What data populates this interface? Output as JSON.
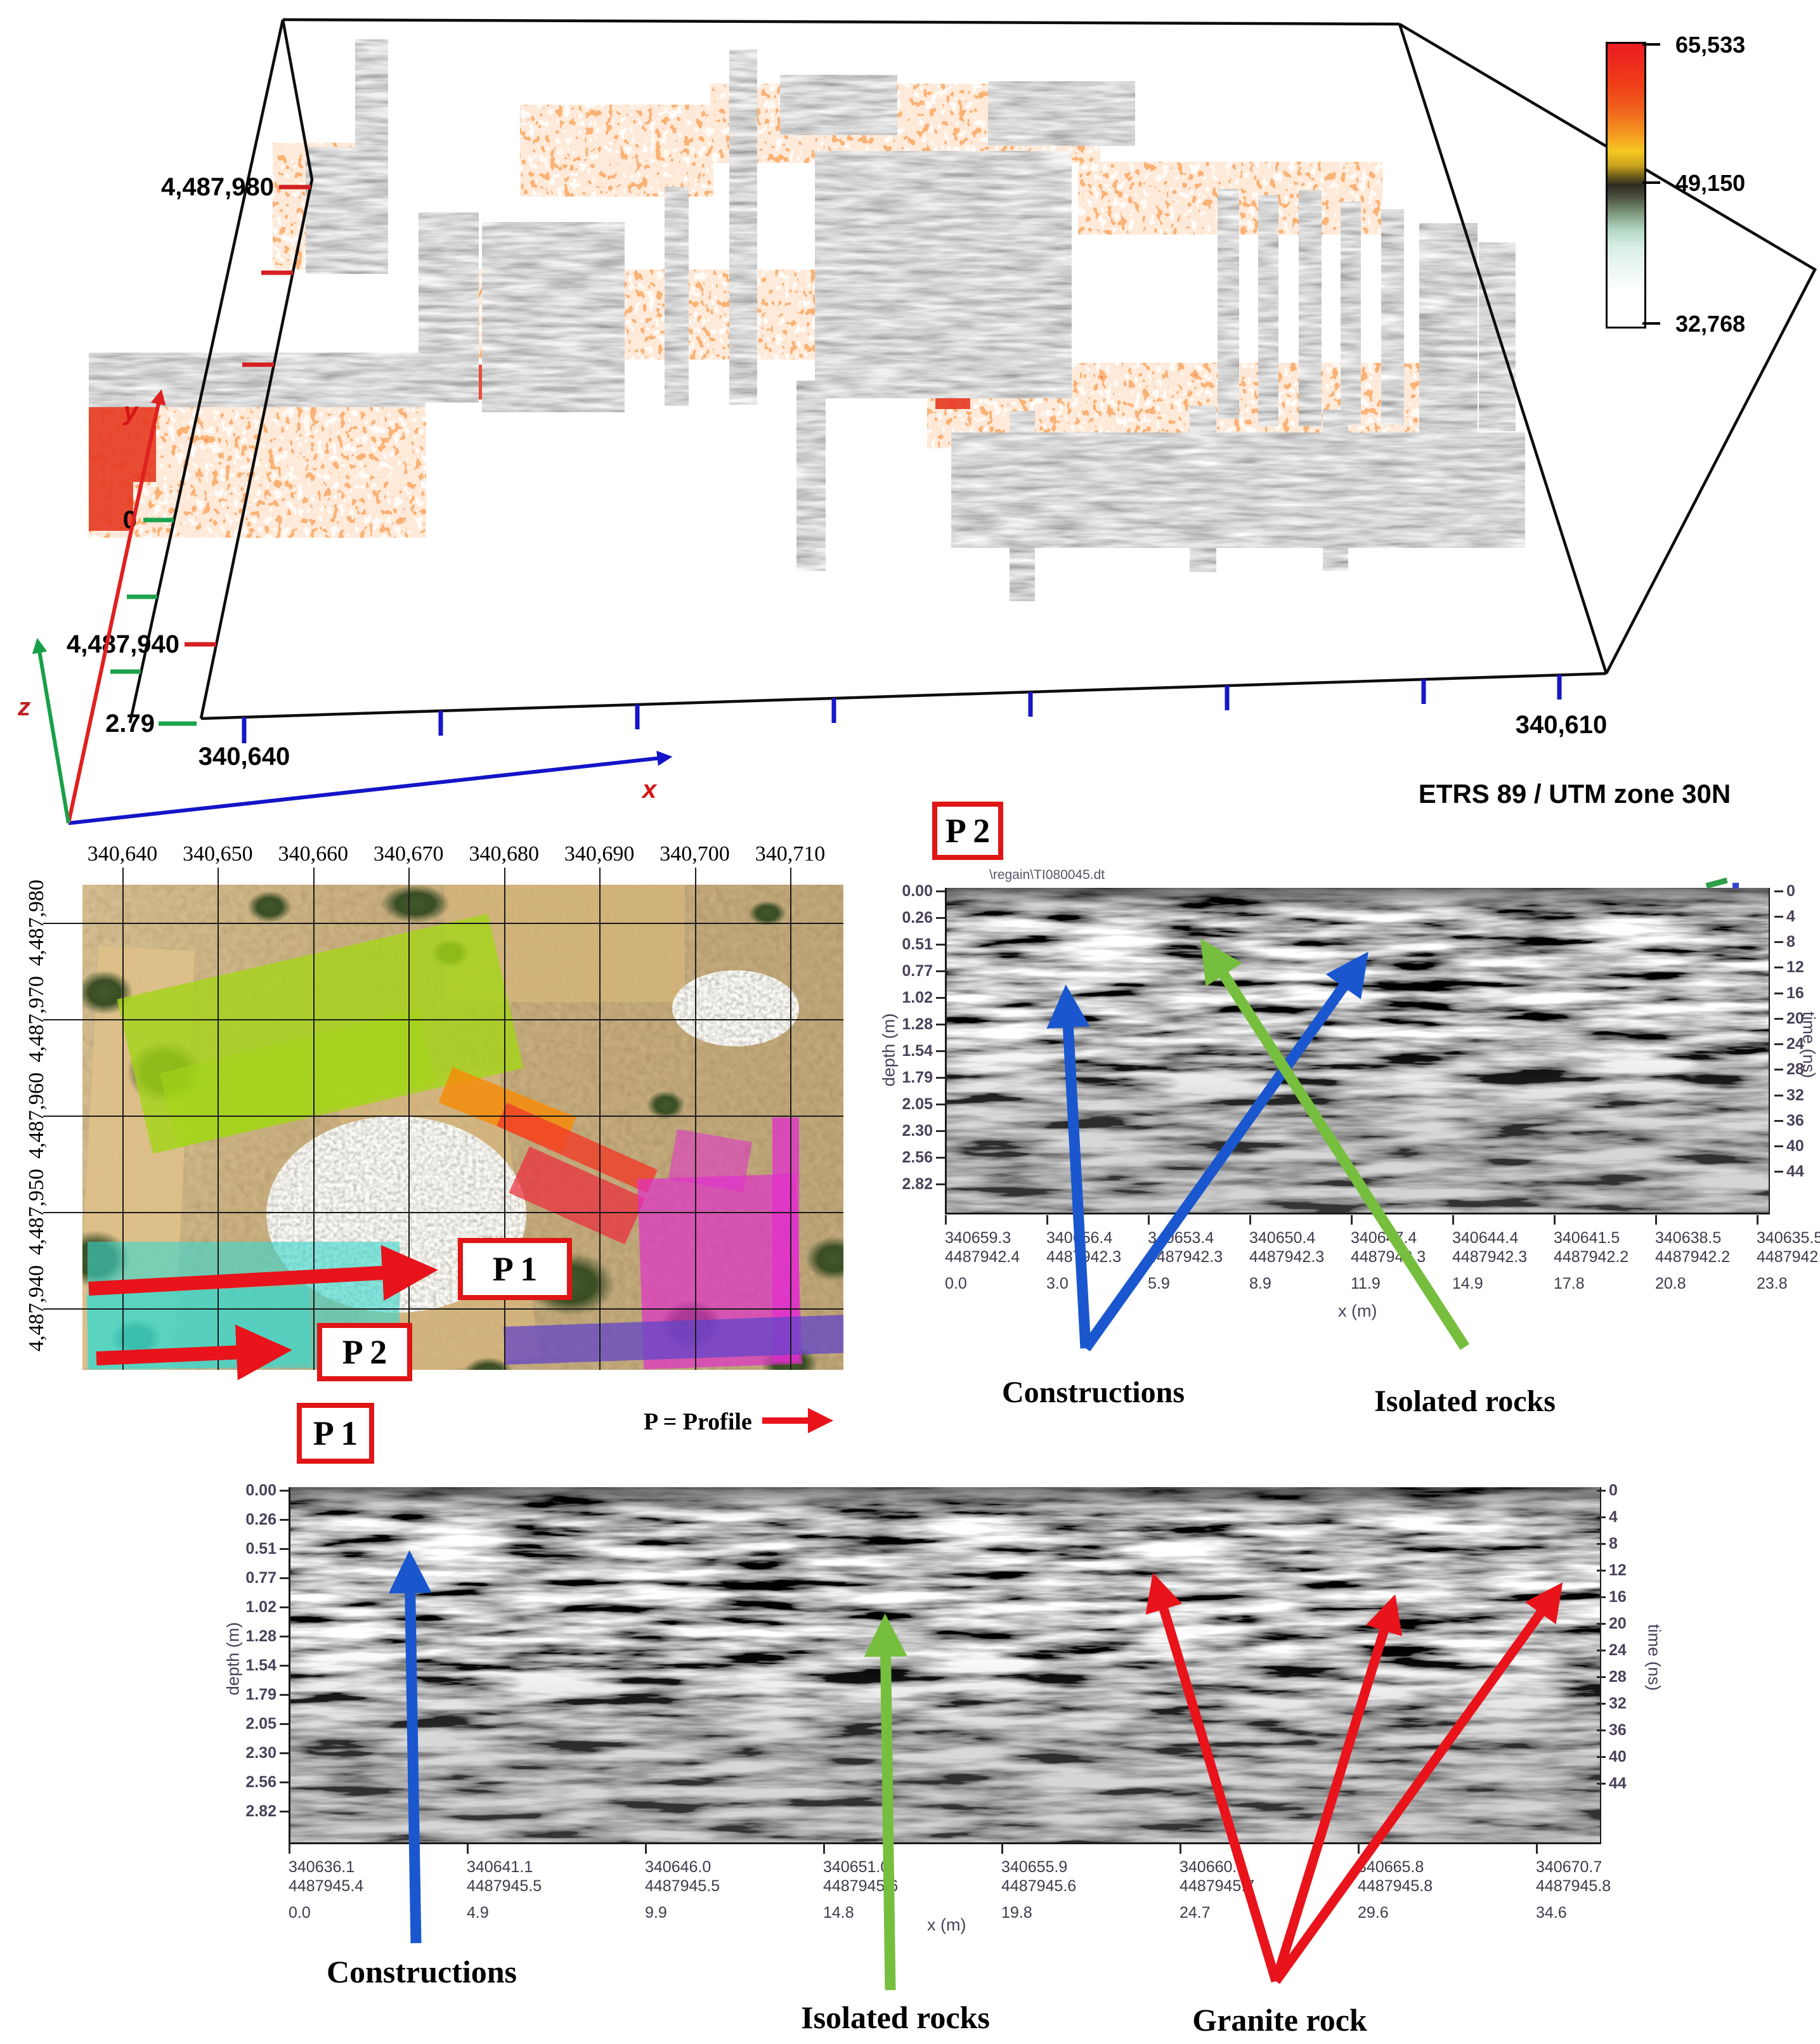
{
  "panel3d": {
    "tick_y_max": "4,487,980",
    "tick_y_min": "4,487,940",
    "tick_z_zero": "0",
    "tick_z_max": "2.79",
    "tick_x_left": "340,640",
    "tick_x_right": "340,610",
    "crs": "ETRS 89 / UTM zone 30N",
    "axis_x": "x",
    "axis_y": "y",
    "axis_z": "z",
    "colorbar": {
      "top": "65,533",
      "middle": "49,150",
      "bottom": "32,768"
    }
  },
  "map": {
    "top_ticks": [
      "340,640",
      "340,650",
      "340,660",
      "340,670",
      "340,680",
      "340,690",
      "340,700",
      "340,710"
    ],
    "left_ticks": [
      "4,487,980",
      "4,487,970",
      "4,487,960",
      "4,487,950",
      "4,487,940"
    ],
    "p1_arrow_label": "P 1",
    "p2_arrow_label": "P 2",
    "caption": "P 1",
    "legend": "P = Profile"
  },
  "axes": {
    "depth_label": "depth (m)",
    "time_label": "time (ns)",
    "x_label": "x (m)",
    "depth_ticks": [
      "0.00",
      "0.26",
      "0.51",
      "0.77",
      "1.02",
      "1.28",
      "1.54",
      "1.79",
      "2.05",
      "2.30",
      "2.56",
      "2.82"
    ],
    "time_ticks": [
      "0",
      "4",
      "8",
      "12",
      "16",
      "20",
      "24",
      "28",
      "32",
      "36",
      "40",
      "44"
    ]
  },
  "p2": {
    "title": "P 2",
    "file": "\\regain\\TI080045.dt",
    "bottom_ticks": [
      {
        "e": "340659.3",
        "n": "4487942.4",
        "d": "0.0"
      },
      {
        "e": "340656.4",
        "n": "4487942.3",
        "d": "3.0"
      },
      {
        "e": "340653.4",
        "n": "4487942.3",
        "d": "5.9"
      },
      {
        "e": "340650.4",
        "n": "4487942.3",
        "d": "8.9"
      },
      {
        "e": "340647.4",
        "n": "4487942.3",
        "d": "11.9"
      },
      {
        "e": "340644.4",
        "n": "4487942.3",
        "d": "14.9"
      },
      {
        "e": "340641.5",
        "n": "4487942.2",
        "d": "17.8"
      },
      {
        "e": "340638.5",
        "n": "4487942.2",
        "d": "20.8"
      },
      {
        "e": "340635.5",
        "n": "4487942.2",
        "d": "23.8"
      }
    ],
    "labels": {
      "constructions": "Constructions",
      "isolated": "Isolated rocks"
    }
  },
  "p1": {
    "bottom_ticks": [
      {
        "e": "340636.1",
        "n": "4487945.4",
        "d": "0.0"
      },
      {
        "e": "340641.1",
        "n": "4487945.5",
        "d": "4.9"
      },
      {
        "e": "340646.0",
        "n": "4487945.5",
        "d": "9.9"
      },
      {
        "e": "340651.0",
        "n": "4487945.6",
        "d": "14.8"
      },
      {
        "e": "340655.9",
        "n": "4487945.6",
        "d": "19.8"
      },
      {
        "e": "340660.8",
        "n": "4487945.7",
        "d": "24.7"
      },
      {
        "e": "340665.8",
        "n": "4487945.8",
        "d": "29.6"
      },
      {
        "e": "340670.7",
        "n": "4487945.8",
        "d": "34.6"
      }
    ],
    "labels": {
      "constructions": "Constructions",
      "isolated": "Isolated rocks",
      "granite": "Granite rock"
    }
  }
}
